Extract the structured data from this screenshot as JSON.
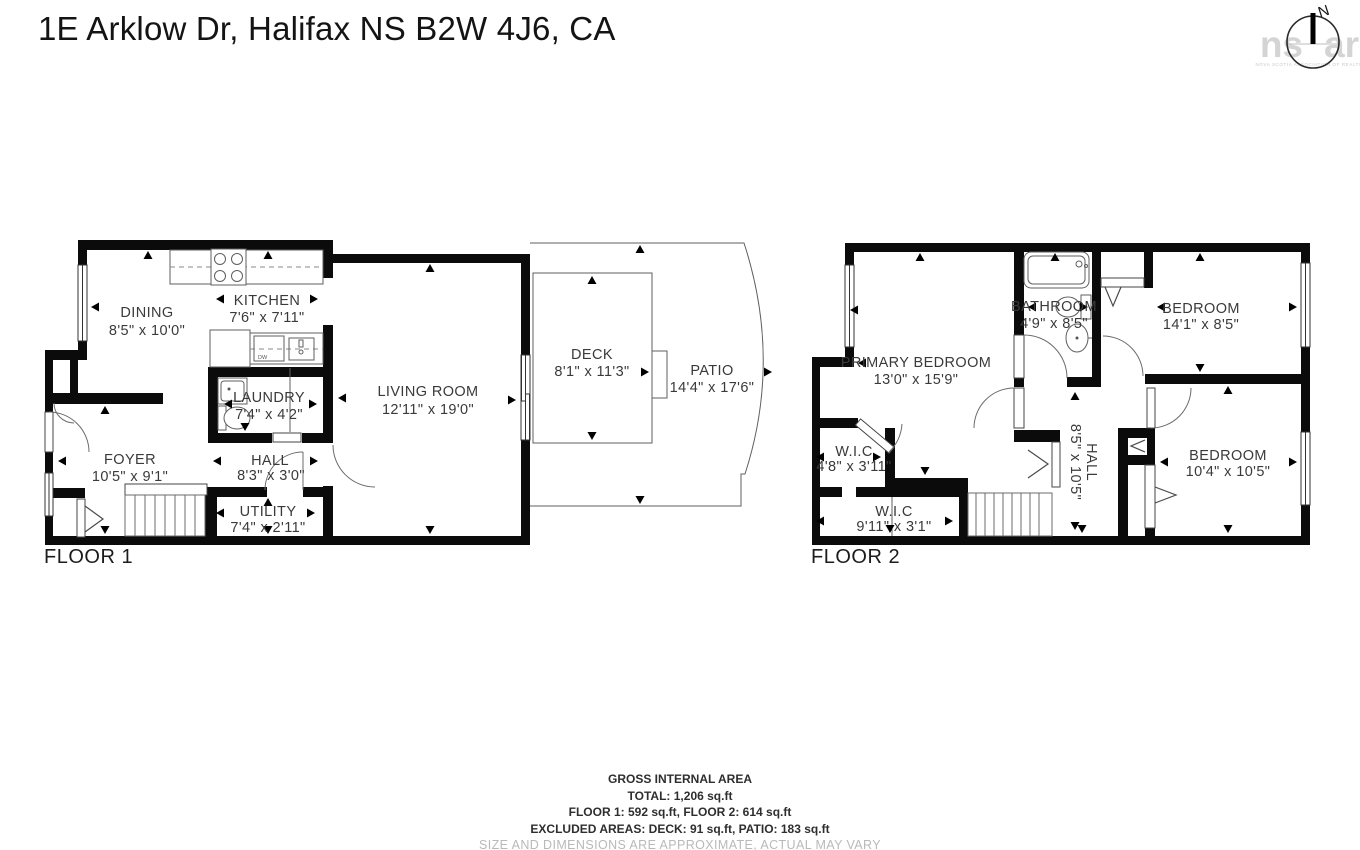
{
  "header": {
    "title": "1E Arklow Dr, Halifax NS B2W 4J6, CA"
  },
  "compass": {
    "north": "N",
    "watermark_left": "ns",
    "watermark_right": "ar",
    "watermark_sub": "NOVA SCOTIA ASSOCIATION OF REALTORS"
  },
  "floor1": {
    "label": "FLOOR 1",
    "rooms": [
      {
        "name": "DINING",
        "dims": "8'5\" x 10'0\""
      },
      {
        "name": "KITCHEN",
        "dims": "7'6\" x 7'11\""
      },
      {
        "name": "LIVING ROOM",
        "dims": "12'11\" x 19'0\""
      },
      {
        "name": "DECK",
        "dims": "8'1\" x 11'3\""
      },
      {
        "name": "PATIO",
        "dims": "14'4\" x 17'6\""
      },
      {
        "name": "LAUNDRY",
        "dims": "7'4\" x 4'2\""
      },
      {
        "name": "FOYER",
        "dims": "10'5\" x 9'1\""
      },
      {
        "name": "HALL",
        "dims": "8'3\" x 3'0\""
      },
      {
        "name": "UTILITY",
        "dims": "7'4\" x 2'11\""
      }
    ],
    "fixtures": {
      "dishwasher": "DW"
    }
  },
  "floor2": {
    "label": "FLOOR 2",
    "rooms": [
      {
        "name": "PRIMARY BEDROOM",
        "dims": "13'0\" x 15'9\""
      },
      {
        "name": "BATHROOM",
        "dims": "4'9\" x 8'5\""
      },
      {
        "name": "BEDROOM",
        "dims": "14'1\" x 8'5\""
      },
      {
        "name": "W.I.C",
        "dims": "4'8\" x 3'11\""
      },
      {
        "name": "W.I.C",
        "dims": "9'11\" x 3'1\""
      },
      {
        "name": "HALL",
        "dims": "8'5\" x 10'5\""
      },
      {
        "name": "BEDROOM",
        "dims": "10'4\" x 10'5\""
      }
    ]
  },
  "footer": {
    "line1": "GROSS INTERNAL AREA",
    "line2": "TOTAL: 1,206 sq.ft",
    "line3": "FLOOR 1: 592 sq.ft, FLOOR 2: 614 sq.ft",
    "line4": "EXCLUDED AREAS: DECK: 91 sq.ft, PATIO: 183 sq.ft",
    "line5": "SIZE AND DIMENSIONS ARE APPROXIMATE, ACTUAL MAY VARY"
  }
}
